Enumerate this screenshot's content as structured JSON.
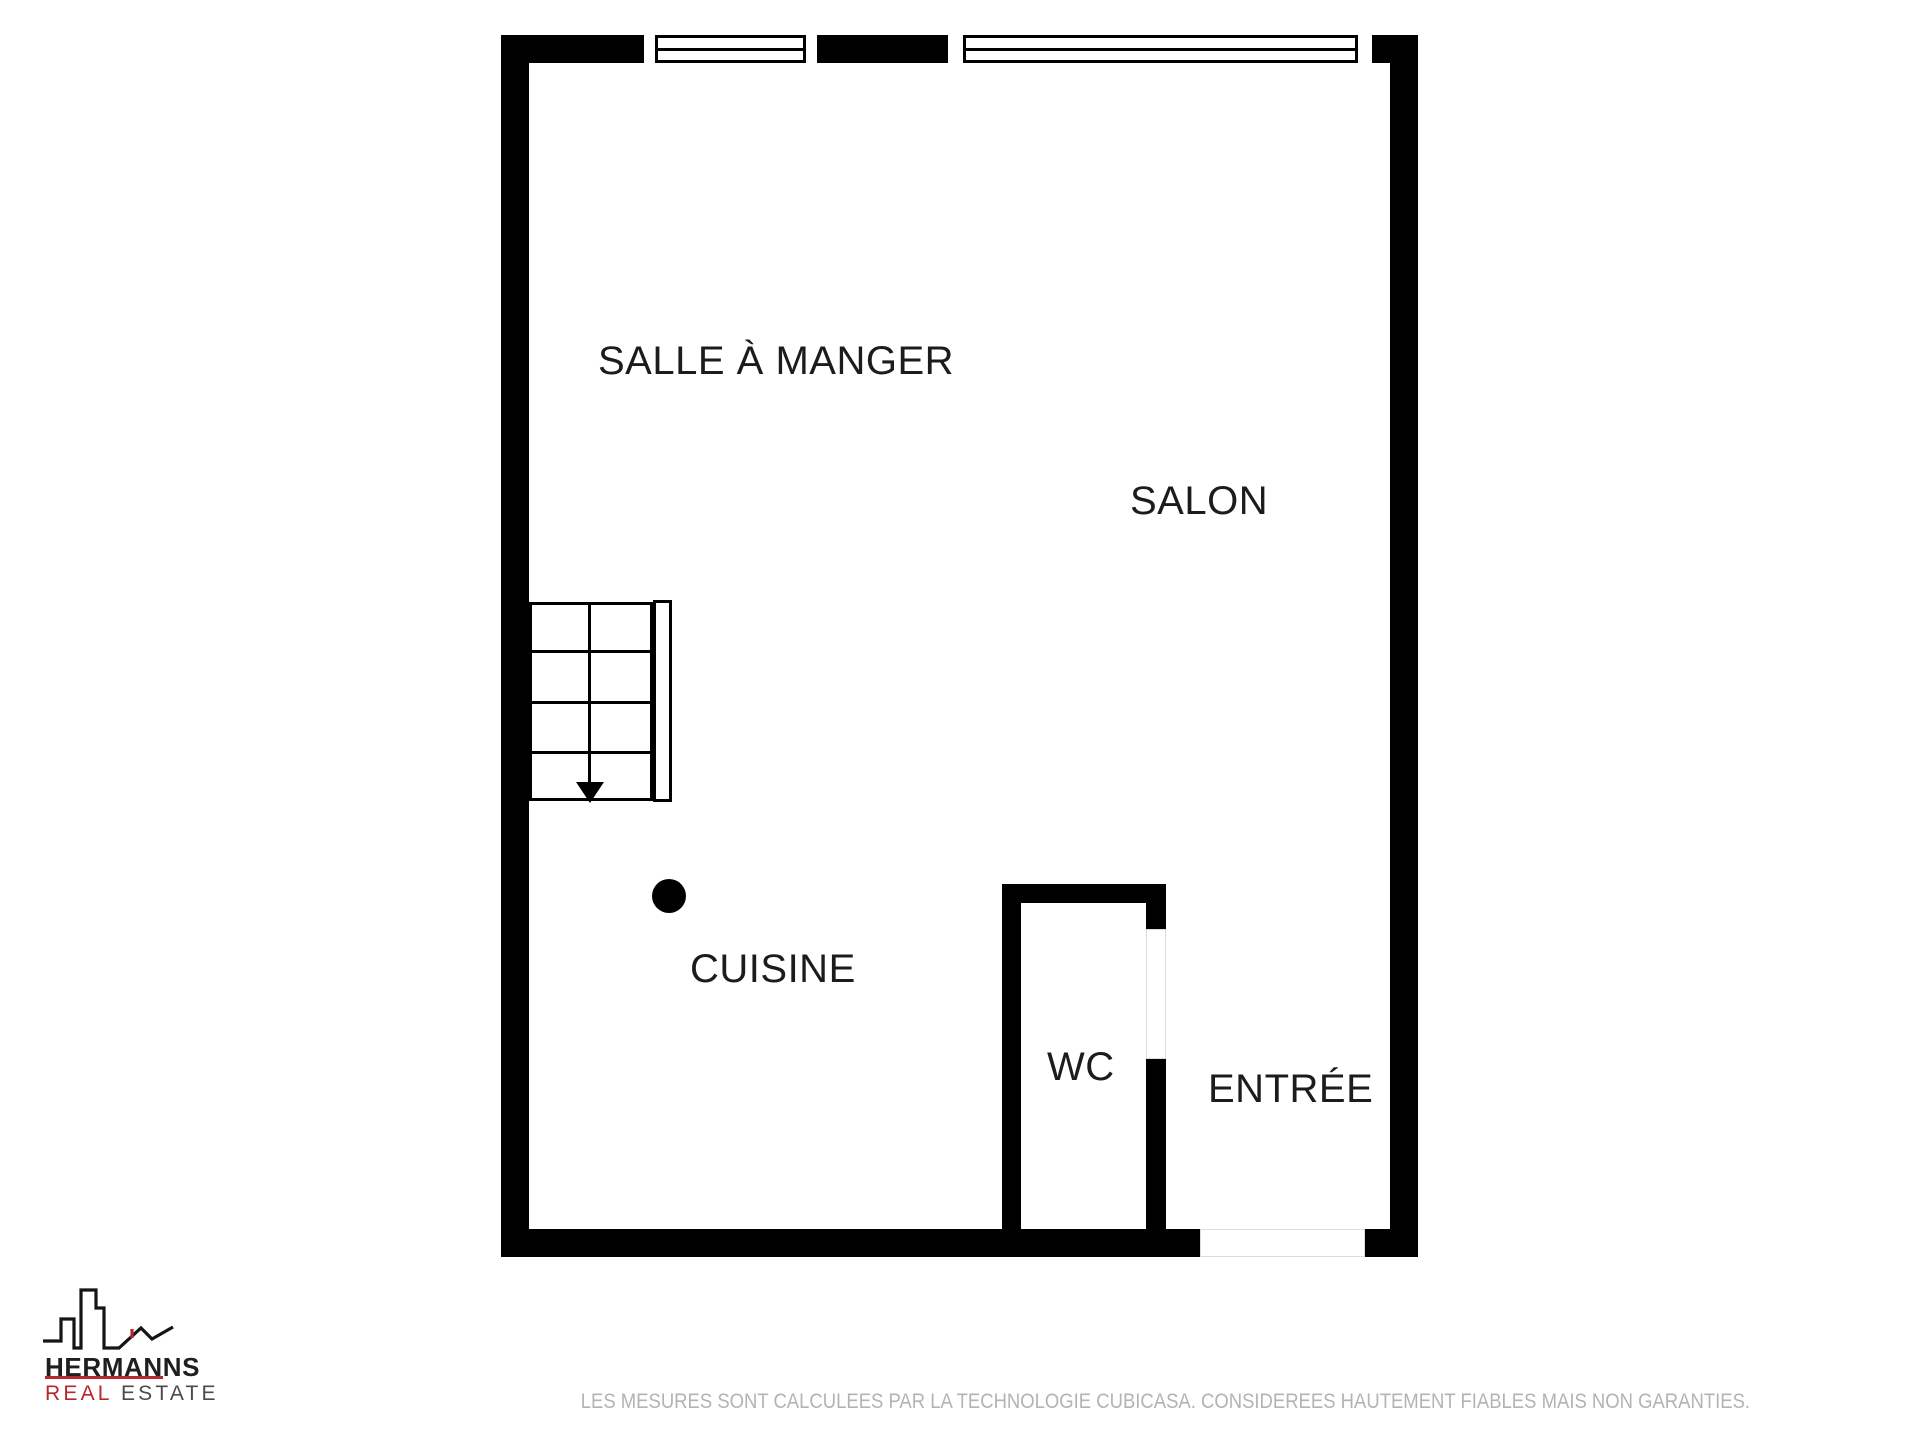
{
  "colors": {
    "background": "#ffffff",
    "wall": "#000000",
    "label_text": "#1c1c1c",
    "accent_red": "#b5282d",
    "tagline_gray": "#4b4b4b",
    "disclaimer_gray": "#b3b3b3"
  },
  "floorplan": {
    "rooms": {
      "salle_a_manger": {
        "label": "SALLE À MANGER"
      },
      "salon": {
        "label": "SALON"
      },
      "cuisine": {
        "label": "CUISINE"
      },
      "wc": {
        "label": "WC"
      },
      "entree": {
        "label": "ENTRÉE"
      }
    }
  },
  "branding": {
    "company": "HERMANNS",
    "tagline_primary": "REAL",
    "tagline_secondary": "ESTATE"
  },
  "footer": {
    "disclaimer": "LES MESURES SONT CALCULEES PAR LA TECHNOLOGIE CUBICASA. CONSIDEREES HAUTEMENT FIABLES MAIS NON GARANTIES."
  }
}
